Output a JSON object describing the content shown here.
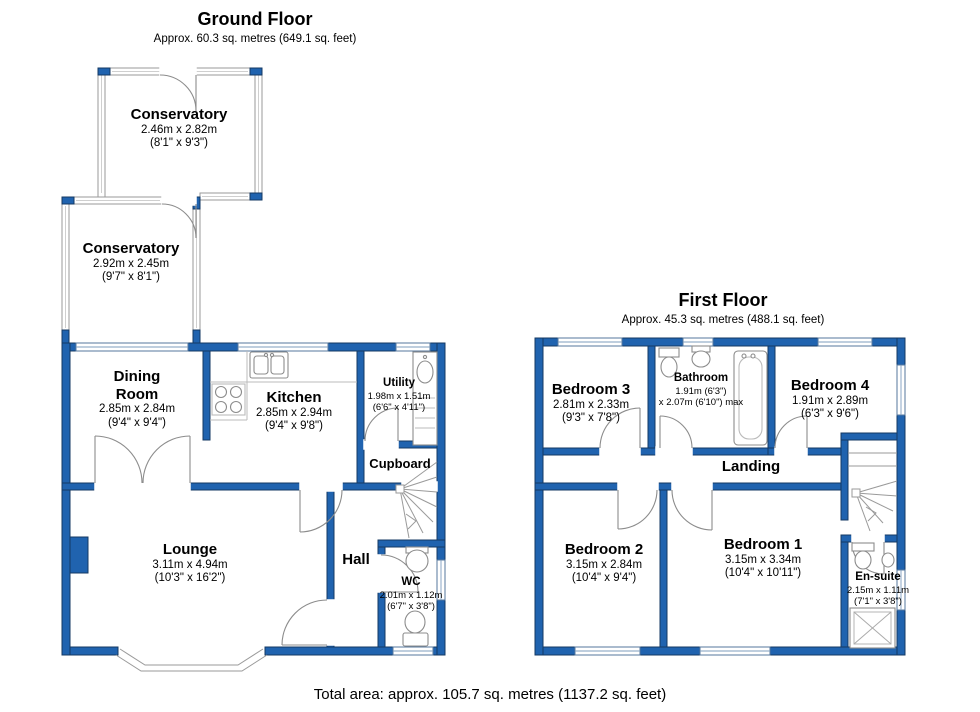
{
  "page": {
    "total_area": "Total area: approx. 105.7 sq. metres (1137.2 sq. feet)"
  },
  "colors": {
    "wall_blue": "#2063af",
    "wall_outline": "#153a63",
    "detail_gray": "#8c8c8c",
    "text": "#000000",
    "background": "#ffffff"
  },
  "ground_floor": {
    "title": "Ground Floor",
    "subtitle": "Approx. 60.3 sq. metres (649.1 sq. feet)",
    "rooms": [
      {
        "name": "Conservatory",
        "dim_m": "2.46m x 2.82m",
        "dim_ft": "(8'1\" x 9'3\")"
      },
      {
        "name": "Conservatory",
        "dim_m": "2.92m x 2.45m",
        "dim_ft": "(9'7\" x 8'1\")"
      },
      {
        "name": "Dining Room",
        "dim_m": "2.85m x 2.84m",
        "dim_ft": "(9'4\" x 9'4\")"
      },
      {
        "name": "Kitchen",
        "dim_m": "2.85m x 2.94m",
        "dim_ft": "(9'4\" x 9'8\")"
      },
      {
        "name": "Utility",
        "dim_m": "1.98m x 1.51m",
        "dim_ft": "(6'6\" x 4'11\")"
      },
      {
        "name": "Cupboard"
      },
      {
        "name": "Lounge",
        "dim_m": "3.11m x 4.94m",
        "dim_ft": "(10'3\" x 16'2\")"
      },
      {
        "name": "Hall"
      },
      {
        "name": "WC",
        "dim_m": "2.01m x 1.12m",
        "dim_ft": "(6'7\" x 3'8\")"
      }
    ]
  },
  "first_floor": {
    "title": "First Floor",
    "subtitle": "Approx. 45.3 sq. metres (488.1 sq. feet)",
    "rooms": [
      {
        "name": "Bedroom 3",
        "dim_m": "2.81m x 2.33m",
        "dim_ft": "(9'3\" x 7'8\")"
      },
      {
        "name": "Bathroom",
        "dim_m": "1.91m (6'3\")",
        "dim_ft": "x 2.07m (6'10\") max"
      },
      {
        "name": "Bedroom 4",
        "dim_m": "1.91m x 2.89m",
        "dim_ft": "(6'3\" x 9'6\")"
      },
      {
        "name": "Landing"
      },
      {
        "name": "Bedroom 2",
        "dim_m": "3.15m x 2.84m",
        "dim_ft": "(10'4\" x 9'4\")"
      },
      {
        "name": "Bedroom 1",
        "dim_m": "3.15m x 3.34m",
        "dim_ft": "(10'4\" x 10'11\")"
      },
      {
        "name": "En-suite",
        "dim_m": "2.15m x 1.11m",
        "dim_ft": "(7'1\" x 3'8\")"
      }
    ]
  }
}
